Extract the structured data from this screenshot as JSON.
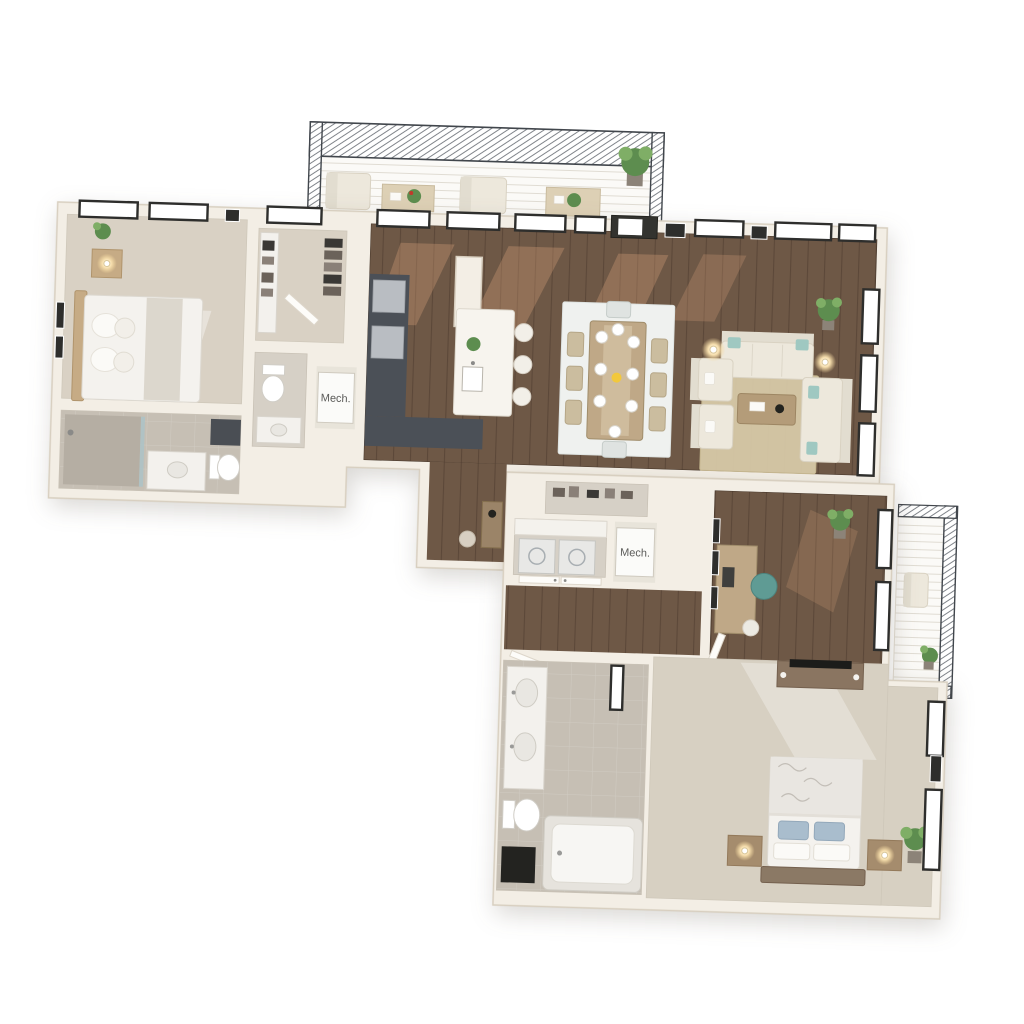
{
  "scene": {
    "type": "3d-apartment-floor-plan-render",
    "labels": {
      "mech_1": "Mech.",
      "mech_2": "Mech."
    }
  },
  "colors": {
    "background": "#ffffff",
    "wall": "#f3eee5",
    "wall_edge": "#d8cfc0",
    "wood_floor": "#6e5846",
    "wood_reflection": "#e3a97f",
    "carpet": "#d9d1c4",
    "carpet_bedroom2": "#d7d0c2",
    "tile": "#c6bfb4",
    "tile_light": "#d6d0c6",
    "counter_dark": "#4b5057",
    "stainless": "#b9bdc2",
    "island": "#f7f4ee",
    "furniture_white": "#ede8dc",
    "teal_pillow": "#9fc8c1",
    "rug_dining": "#eff1ef",
    "rug_jute": "#d7c9a7",
    "wood_table": "#bfa887",
    "wood_dark": "#8a7561",
    "nightstand": "#a58c6d",
    "bed_white": "#f4f2ee",
    "bed_floral": "#e9e6e1",
    "pillow_blue": "#a9bdcd",
    "lamp_glow": "#f4d89e",
    "plant": "#5d8d4f",
    "plant_light": "#7fae66",
    "window_frame": "#2e2e2c",
    "glass": "#ffffff",
    "railing": "#3e434a",
    "mech_box": "#fbfbf9",
    "label_text": "#5a5a58",
    "closet_rug": "#55504b"
  }
}
